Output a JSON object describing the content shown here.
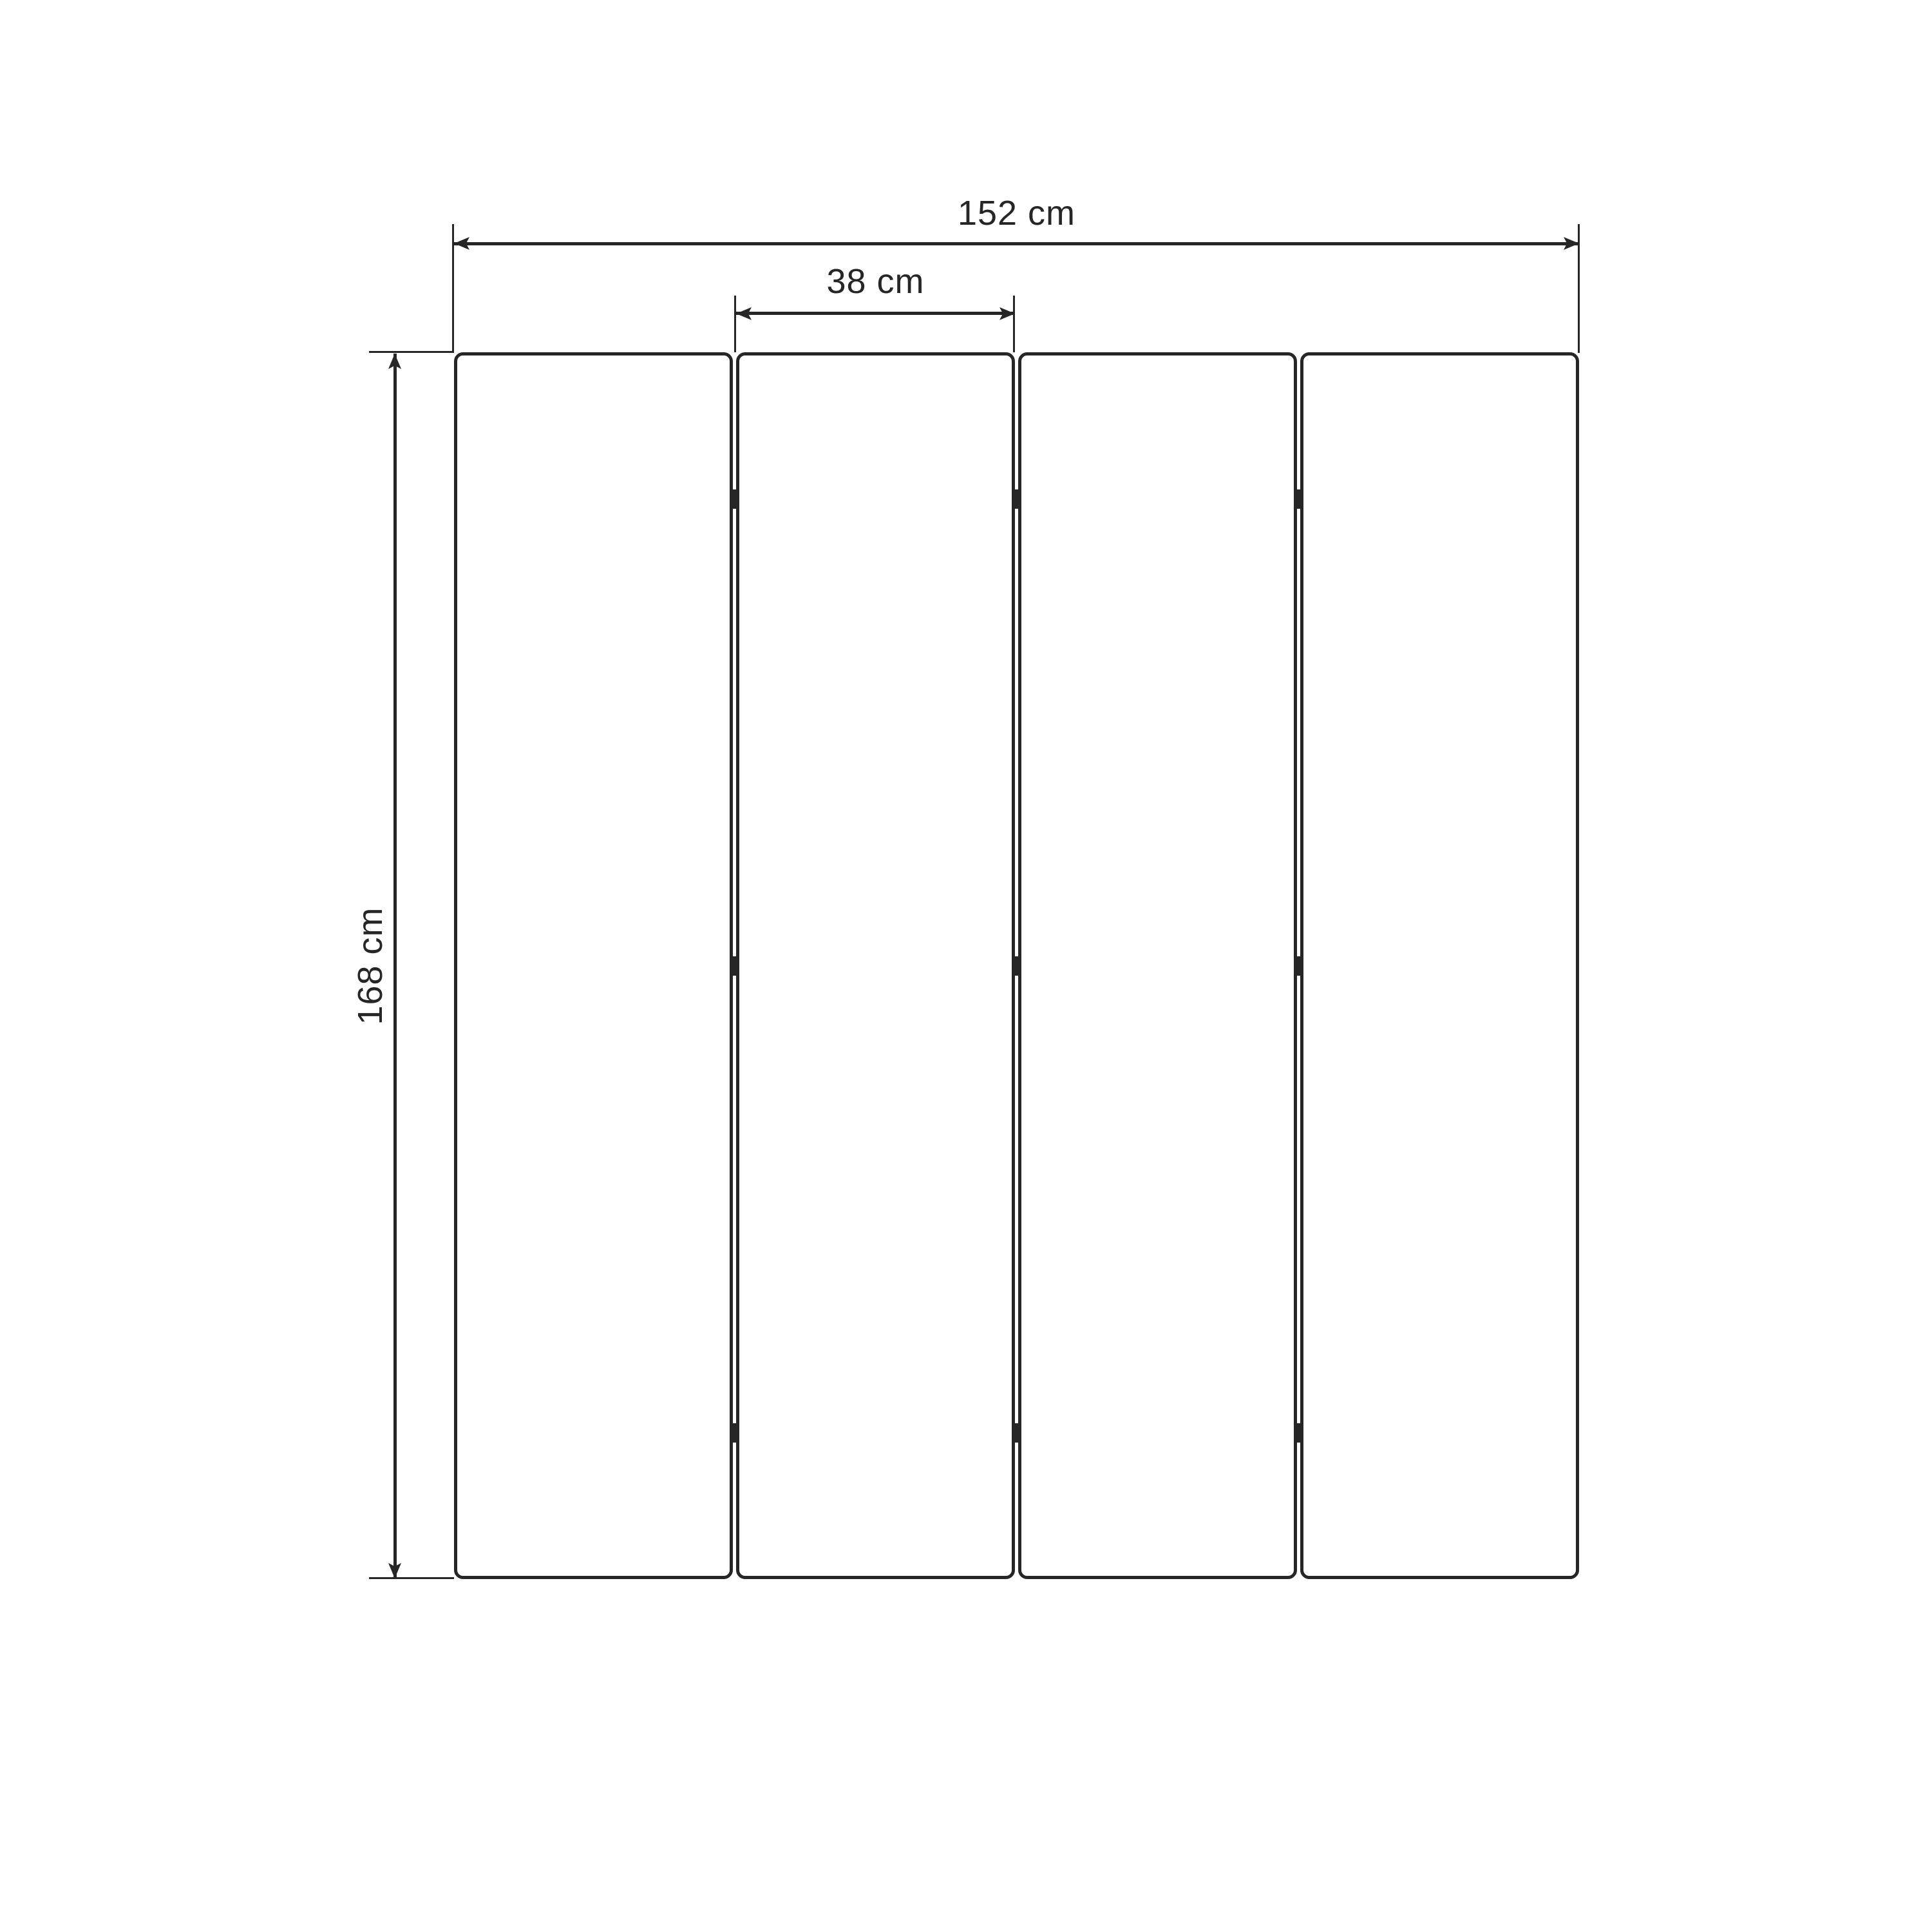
{
  "drawing": {
    "title": "folding-screen-panel-dimension-diagram",
    "background_color": "#ffffff",
    "line_color": "#262626",
    "panel_count": 4,
    "hinge_rows": 3,
    "hinge_marks_total": 9,
    "dimensions": {
      "total_width": {
        "label": "152 cm",
        "value": 152,
        "unit": "cm"
      },
      "panel_width": {
        "label": "38 cm",
        "value": 38,
        "unit": "cm"
      },
      "height": {
        "label": "168 cm",
        "value": 168,
        "unit": "cm"
      }
    }
  }
}
